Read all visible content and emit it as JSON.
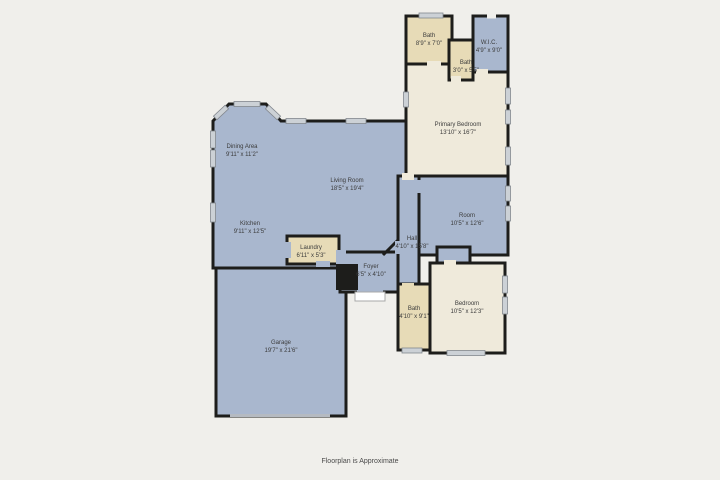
{
  "title": "Floor plan",
  "footer": {
    "disclaimer": "Floorplan is Approximate"
  },
  "colors": {
    "background": "#f0efeb",
    "room_blue": "#a9b7ce",
    "room_tan": "#e7dbb7",
    "room_cream": "#efeadb",
    "wall": "#1d1d1b",
    "window": "#ccd1d6",
    "garage_door": "#b5bac1",
    "label_text": "#3c3c3c"
  },
  "rooms": [
    {
      "name": "Bath",
      "dims": "8'9\" x 7'0\""
    },
    {
      "name": "W.I.C.",
      "dims": "4'9\" x 9'0\""
    },
    {
      "name": "Bath",
      "dims": "3'0\" x 5'5\""
    },
    {
      "name": "Primary Bedroom",
      "dims": "13'10\" x 16'7\""
    },
    {
      "name": "Dining Area",
      "dims": "9'11\" x 11'2\""
    },
    {
      "name": "Living Room",
      "dims": "18'5\" x 19'4\""
    },
    {
      "name": "Kitchen",
      "dims": "9'11\" x 12'5\""
    },
    {
      "name": "Laundry",
      "dims": "6'11\" x 5'3\""
    },
    {
      "name": "Foyer",
      "dims": "6'5\" x 4'10\""
    },
    {
      "name": "Hall",
      "dims": "4'10\" x 15'8\""
    },
    {
      "name": "Room",
      "dims": "10'5\" x 12'6\""
    },
    {
      "name": "Bath",
      "dims": "4'10\" x 9'1\""
    },
    {
      "name": "Bedroom",
      "dims": "10'5\" x 12'3\""
    },
    {
      "name": "Garage",
      "dims": "19'7\" x 21'6\""
    }
  ]
}
